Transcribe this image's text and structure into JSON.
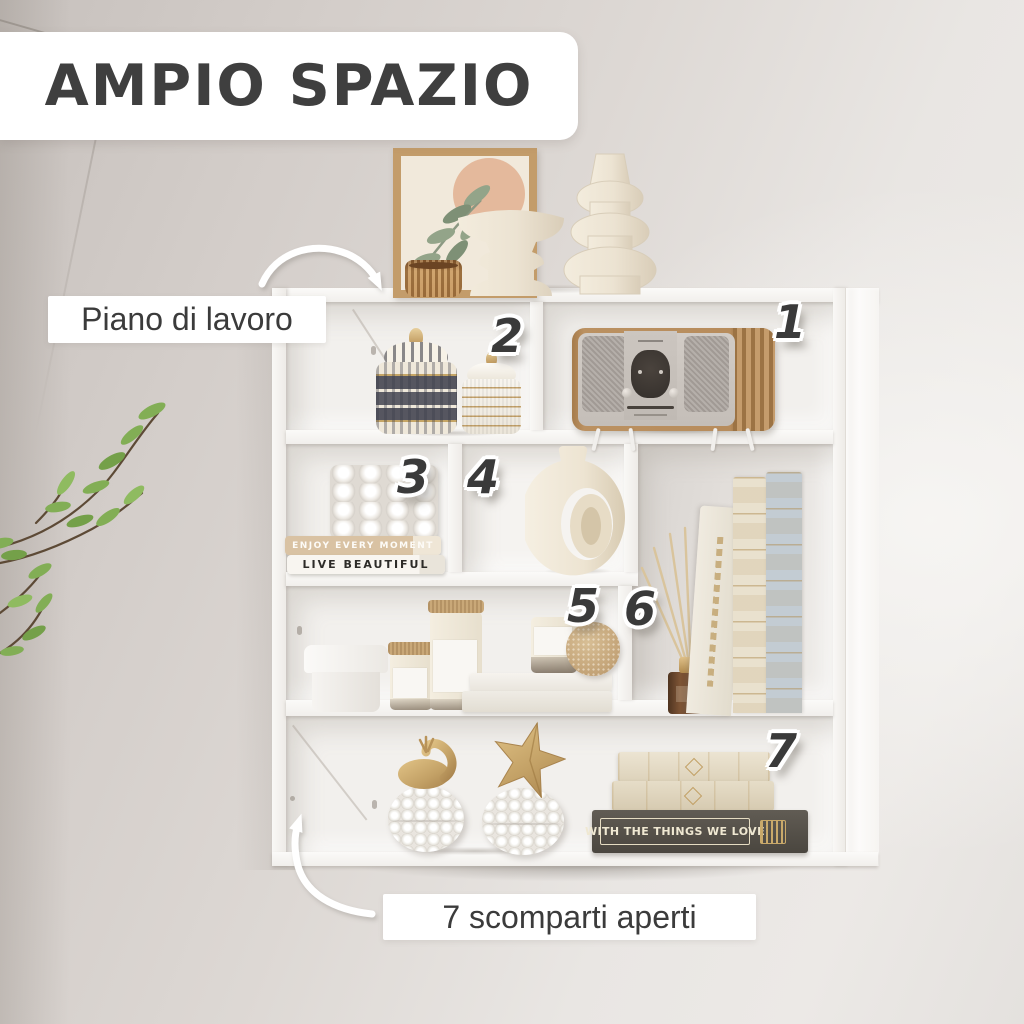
{
  "headline": {
    "text": "AMPIO SPAZIO"
  },
  "callouts": {
    "top": "Piano di lavoro",
    "bottom": "7 scomparti aperti"
  },
  "badges": [
    "1",
    "2",
    "3",
    "4",
    "5",
    "6",
    "7"
  ],
  "decor_text": {
    "book_spine_1": "ENJOY EVERY MOMENT",
    "book_spine_2": "LIVE BEAUTIFUL",
    "book_spine_3": "WITH THE THINGS WE LOVE"
  },
  "colors": {
    "headline_text": "#3f3f3f",
    "badge_text": "#3a3a3a",
    "callout_bg": "#ffffff",
    "wall": "#d8d3cf",
    "shelf_white": "#f7f5f3",
    "wood": "#b8905f",
    "gold": "#c8a76c",
    "plant_green": "#82ae55",
    "dark_book": "#55514a",
    "blue_book": "#c3ccd3"
  }
}
